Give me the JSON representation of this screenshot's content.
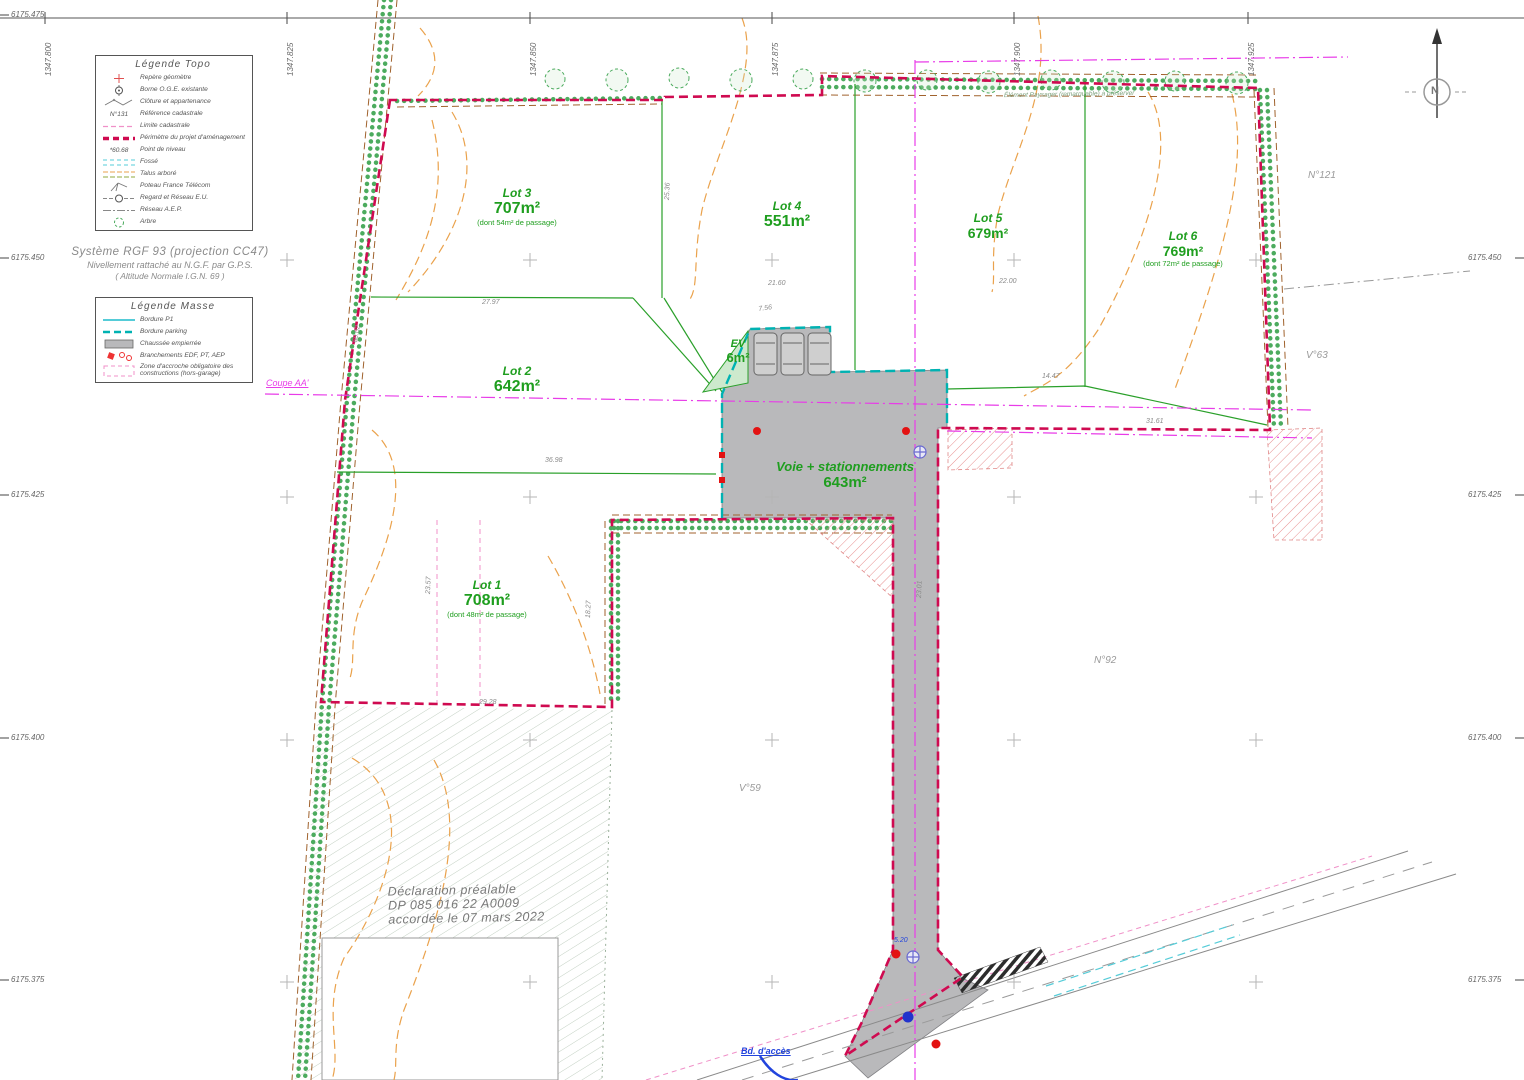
{
  "frame": {
    "x_labels": [
      "1347.800",
      "1347.825",
      "1347.850",
      "1347.875",
      "1347.900",
      "1347.925"
    ],
    "y_labels_left": [
      "6175.475",
      "6175.450",
      "6175.425",
      "6175.400",
      "6175.375"
    ],
    "y_labels_right": [
      "6175.450",
      "6175.425",
      "6175.400",
      "6175.375"
    ]
  },
  "header": {
    "system_line1": "Système RGF 93 (projection CC47)",
    "system_line2": "Nivellement rattaché au N.G.F. par G.P.S.",
    "system_line3": "( Altitude Normale I.G.N. 69 )"
  },
  "legend_topo": {
    "title": "Légende Topo",
    "items": [
      {
        "label": "Repère géomètre"
      },
      {
        "label": "Borne O.G.E. existante"
      },
      {
        "label": "Clôture et appartenance"
      },
      {
        "label": "Référence cadastrale",
        "symbol_text": "N°131"
      },
      {
        "label": "Limite cadastrale"
      },
      {
        "label": "Périmètre du projet d'aménagement"
      },
      {
        "label": "Point de niveau",
        "symbol_text": "60.68"
      },
      {
        "label": "Fossé"
      },
      {
        "label": "Talus arboré"
      },
      {
        "label": "Poteau France Télécom"
      },
      {
        "label": "Regard et Réseau E.U."
      },
      {
        "label": "Réseau A.E.P."
      },
      {
        "label": "Arbre"
      }
    ]
  },
  "legend_masse": {
    "title": "Légende Masse",
    "items": [
      {
        "label": "Bordure P1"
      },
      {
        "label": "Bordure parking"
      },
      {
        "label": "Chaussée empierrée"
      },
      {
        "label": "Branchements EDF, PT, AEP"
      },
      {
        "label": "Zone d'accroche obligatoire des constructions (hors-garage)"
      }
    ]
  },
  "lots": {
    "lot1": {
      "name": "Lot 1",
      "area": "708m²",
      "note": "(dont 48m² de passage)"
    },
    "lot2": {
      "name": "Lot 2",
      "area": "642m²"
    },
    "lot3": {
      "name": "Lot 3",
      "area": "707m²",
      "note": "(dont 54m² de passage)"
    },
    "lot4": {
      "name": "Lot 4",
      "area": "551m²"
    },
    "lot5": {
      "name": "Lot 5",
      "area": "679m²"
    },
    "lot6": {
      "name": "Lot 6",
      "area": "769m²",
      "note": "(dont 72m² de passage)"
    }
  },
  "road": {
    "label": "Voie + stationnements",
    "area": "643m²"
  },
  "ev": {
    "label": "EV",
    "area": "6m²"
  },
  "declaration": {
    "line1": "Déclaration préalable",
    "line2": "DP 085 016 22 A0009",
    "line3": "accordée le 07 mars 2022"
  },
  "annotations": {
    "coupe": "Coupe AA'",
    "north": "N",
    "access": "Bd. d'accès",
    "hedge_note": "Élément Paysager (remarquable) à préserver",
    "ref_n121": "N°121",
    "ref_v63": "V°63",
    "ref_n92": "N°92",
    "ref_v59": "V°59"
  },
  "dims": [
    {
      "t": "27.97"
    },
    {
      "t": "36.98"
    },
    {
      "t": "21.60"
    },
    {
      "t": "22.00"
    },
    {
      "t": "14.47"
    },
    {
      "t": "29.28"
    },
    {
      "t": "18.27"
    },
    {
      "t": "23.57"
    },
    {
      "t": "60.02"
    },
    {
      "t": "7.56"
    },
    {
      "t": "5.20"
    },
    {
      "t": "25.36"
    },
    {
      "t": "23.01"
    },
    {
      "t": "31.61"
    }
  ],
  "colors": {
    "lot_green": "#1f9e1f",
    "perimeter": "#cf0a50",
    "magenta": "#e83ce8",
    "hedge": "#4cab5e",
    "contour": "#eaa24c",
    "road_fill": "#b9b9bb",
    "cyan": "#55ccd8",
    "pink": "#f090c8"
  }
}
